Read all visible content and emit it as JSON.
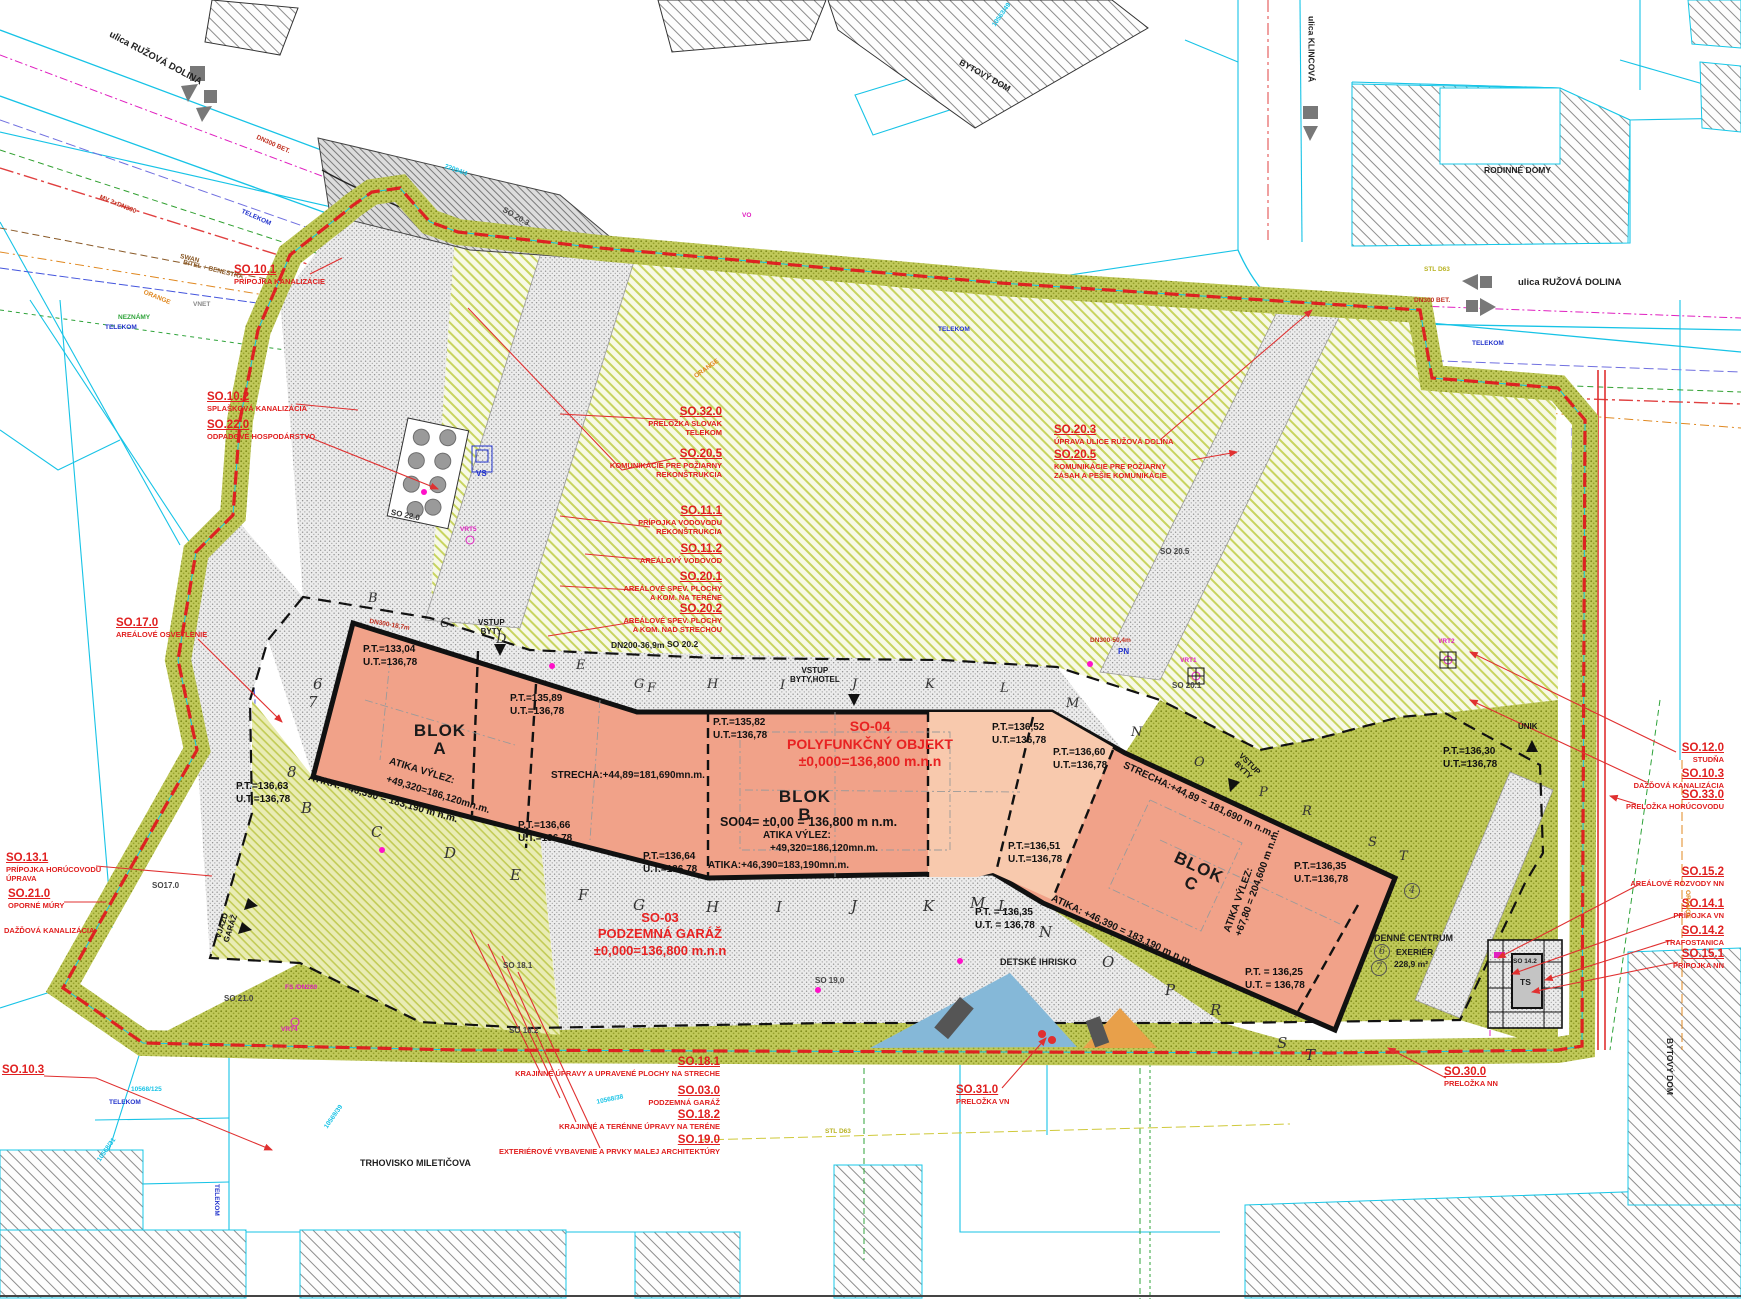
{
  "streets": {
    "ruzova_nw": "ulica RUŽOVÁ DOLINA",
    "ruzova_e": "ulica RUŽOVÁ DOLINA",
    "klincova": "ulica KLINCOVÁ"
  },
  "areas": {
    "bytovy_dom_top": "BYTOVÝ DOM",
    "bytovy_dom_right": "BYTOVÝ DOM",
    "rodinne_domy": "RODINNÉ DOMY",
    "trhovisko": "TRHOVISKO MILETIČOVA",
    "detske_ihrisko": "DETSKÉ IHRISKO",
    "denne_centrum": "DENNÉ CENTRUM",
    "denne_centrum_sub": "EXERIÉR",
    "denne_centrum_area": "228,9 m²"
  },
  "callouts": {
    "so101": {
      "code": "SO.10.1",
      "desc": "PRÍPOJKA KANALIZÁCIE"
    },
    "so102": {
      "code": "SO.10.2",
      "desc": "SPLAŠKOVÁ KANALIZÁCIA"
    },
    "so220": {
      "code": "SO.22.0",
      "desc": "ODPADOVÉ HOSPODÁRSTVO"
    },
    "so170": {
      "code": "SO.17.0",
      "desc": "AREÁLOVÉ OSVETLENIE"
    },
    "so131": {
      "code": "SO.13.1",
      "desc": "PRÍPOJKA HORÚCOVODU\nÚPRAVA"
    },
    "so210": {
      "code": "SO.21.0",
      "desc": "OPORNÉ MÚRY"
    },
    "dazdova": {
      "desc": "DAŽĎOVÁ KANALIZÁCIA"
    },
    "so103l": {
      "code": "SO.10.3"
    },
    "so320": {
      "code": "SO.32.0",
      "desc": "PRELOŽKA SLOVAK\nTELEKOM"
    },
    "so205a": {
      "code": "SO.20.5",
      "desc": "KOMUNIKÁCIE PRE POŽIARNY\nREKONŠTRUKCIA"
    },
    "so111": {
      "code": "SO.11.1",
      "desc": "PRÍPOJKA VODOVODU\nREKONŠTRUKCIA"
    },
    "so112": {
      "code": "SO.11.2",
      "desc": "AREÁLOVÝ VODOVOD"
    },
    "so201": {
      "code": "SO.20.1",
      "desc": "AREÁLOVÉ SPEV. PLOCHY\nA KOM. NA TERÉNE"
    },
    "so202": {
      "code": "SO.20.2",
      "desc": "AREÁLOVÉ SPEV. PLOCHY\nA KOM. NAD STRECHOU"
    },
    "so203": {
      "code": "SO.20.3",
      "desc": "ÚPRAVA ULICE RUŽOVÁ DOLINA"
    },
    "so205b": {
      "code": "SO.20.5",
      "desc": "KOMUNIKÁCIE PRE POŽIARNY\nZÁSAH A PEŠIE KOMUNIKÁCIE"
    },
    "so120": {
      "code": "SO.12.0",
      "desc": "STUDŇA"
    },
    "so103r": {
      "code": "SO.10.3",
      "desc": "DAŽĎOVÁ KANALIZÁCIA"
    },
    "so330": {
      "code": "SO.33.0",
      "desc": "PRELOŽKA HORÚCOVODU"
    },
    "so152": {
      "code": "SO.15.2",
      "desc": "AREÁLOVÉ ROZVODY NN"
    },
    "so141": {
      "code": "SO.14.1",
      "desc": "PRÍPOJKA VN"
    },
    "so142": {
      "code": "SO.14.2",
      "desc": "TRAFOSTANICA"
    },
    "so151": {
      "code": "SO.15.1",
      "desc": "PRÍPOJKA NN"
    },
    "so181": {
      "code": "SO.18.1",
      "desc": "KRAJINNÉ ÚPRAVY A UPRAVENÉ PLOCHY NA STRECHE"
    },
    "so030": {
      "code": "SO.03.0",
      "desc": "PODZEMNÁ GARÁŽ"
    },
    "so182": {
      "code": "SO.18.2",
      "desc": "KRAJINNÉ A TERÉNNE ÚPRAVY NA TERÉNE"
    },
    "so190": {
      "code": "SO.19.0",
      "desc": "EXTERIÉROVÉ VYBAVENIE A PRVKY MALEJ ARCHITEKTÚRY"
    },
    "so310": {
      "code": "SO.31.0",
      "desc": "PRELOŽKA VN"
    },
    "so300": {
      "code": "SO.30.0",
      "desc": "PRELOŽKA NN"
    }
  },
  "buildings": {
    "so04": "SO-04\nPOLYFUNKČNÝ OBJEKT\n±0,000=136,800 m.n.n",
    "so03": "SO-03\nPODZEMNÁ GARÁŽ\n±0,000=136,800 m.n.n",
    "blok_a": "BLOK\nA",
    "blok_b": "BLOK\nB",
    "blok_c": "BLOK\nC",
    "blok_b_level": "SO04= ±0,00 = 136,800 m n.m.",
    "atika_vylez": "ATIKA VÝLEZ:",
    "atika_vylez_value": "+49,320=186,120mn.m.",
    "atika_a": "ATIKA: +46,390 = 183,190 m n.m.",
    "atika_b": "ATIKA:+46,390=183,190mn.m.",
    "atika_c": "ATIKA: +46,390 = 183,190 m n.m.",
    "strecha_a": "STRECHA:+44,89=181,690mn.m.",
    "strecha_c": "STRECHA:+44,89 = 181,690 m n.m.",
    "atika_vylez_c": "ATIKA VÝLEZ:\n+67,80 = 204,600 m n.m."
  },
  "elevations": {
    "e1": "P.T.=133,04\nU.T.=136,78",
    "e2": "P.T.=135,89\nU.T.=136,78",
    "e3": "P.T.=135,82\nU.T.=136,78",
    "e4": "P.T.=136,66\nU.T.=136,78",
    "e5": "P.T.=136,64\nU.T.=136,78",
    "e6": "P.T.=136,63\nU.T.=136,78",
    "e7": "P.T.=136,52\nU.T.=136,78",
    "e8": "P.T.=136,60\nU.T.=136,78",
    "e9": "P.T.=136,51\nU.T.=136,78",
    "e10": "P.T.=136,35\nU.T.=136,78",
    "e11": "P.T. = 136,35\nU.T. = 136,78",
    "e12": "P.T. = 136,25\nU.T. = 136,78",
    "e13": "P.T.=136,30\nU.T.=136,78"
  },
  "grid": {
    "top": [
      "B",
      "C",
      "D",
      "E",
      "G",
      "F",
      "H",
      "I",
      "J",
      "K",
      "L",
      "M",
      "N",
      "O",
      "P",
      "R",
      "S",
      "T"
    ],
    "bottom": [
      "B",
      "C",
      "D",
      "E",
      "F",
      "G",
      "H",
      "I",
      "J",
      "K",
      "M",
      "L",
      "N",
      "O",
      "P",
      "R",
      "S",
      "T"
    ],
    "left": [
      "6",
      "7",
      "8"
    ],
    "circled": [
      "4",
      "6",
      "7"
    ]
  },
  "entries": {
    "vstup1": "VSTUP\nBYTY",
    "vstup2": "VSTUP\nBYTY,HOTEL",
    "vstup3": "VSTUP\nBYTY",
    "unik": "ÚNIK",
    "vjazd": "VJAZD\nGARÁŽ"
  },
  "plan_labels": {
    "so203_small": "SO 20.3",
    "so220_small": "SO 22.0",
    "vs": "VS",
    "pn": "PN",
    "so205_small": "SO 20.5",
    "so201_small": "SO 20.1",
    "so202_small": "SO 20.2",
    "dn200": "DN200-36,9m",
    "dn300_50": "DN300-50,4m",
    "dn300_18": "DN300-18,7m",
    "so181_small": "SO 18.1",
    "so182_small": "SO 18.2",
    "so190_small": "SO 19,0",
    "so210_small": "SO 21.0",
    "so170_small": "SO17.0",
    "so142_small": "SO 14.2",
    "ts": "TS",
    "vrt1": "VRT1",
    "vrt2": "VRT2",
    "vrt4": "VRT4",
    "vrt5": "VRT5"
  },
  "utilities": {
    "telekom": "TELEKOM",
    "orange": "ORANGE",
    "swan": "SWAN",
    "bitel": "BITEL + BENESTRA",
    "vnet": "VNET",
    "neznamy": "NEZNÁMY",
    "dn300bet": "DN300 BET.",
    "mv": "MV 2xDN300",
    "stl": "STL D63",
    "vo": "VO",
    "fs": "FS /DN200"
  },
  "parcels": {
    "p1": "22094/4",
    "p2": "10568/38",
    "p3": "10568/125",
    "p4": "10569/39",
    "p5": "10568/31",
    "p6": "10563/49"
  },
  "colors": {
    "callout_red": "#e02020",
    "boundary_red": "#dd2222",
    "building_salmon": "#f1a289",
    "building_salmon_light": "#f8c9ad",
    "site_olive": "#b9c24f",
    "cadastral_cyan": "#17c3e6"
  }
}
